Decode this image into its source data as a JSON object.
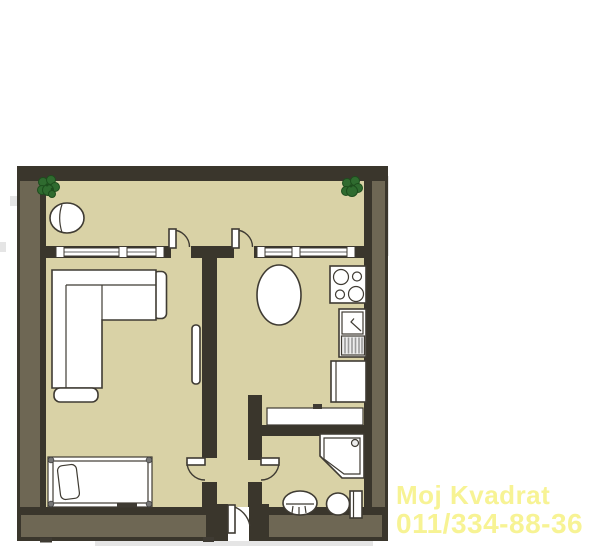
{
  "meta": {
    "type": "floor-plan",
    "description": "Top-down architectural floor plan of a one-bedroom apartment with balcony"
  },
  "watermark": {
    "line1": "Moj Kvadrat",
    "line2": "011/334-88-36"
  },
  "colors": {
    "background": "#ffffff",
    "floor": "#d9d2a6",
    "wall_dark": "#3a362c",
    "wall_light": "#6e6754",
    "furniture_fill": "#ffffff",
    "furniture_stroke": "#3f3b33",
    "plant": "#2f6b2f",
    "plant_dark": "#1d4d1d",
    "drainer": "#ededed",
    "shadow": "#dedede",
    "watermark": "#f7f394"
  },
  "symbols": [
    "balcony-plant-left",
    "balcony-plant-right",
    "balcony-chair",
    "balcony-window-left",
    "balcony-window-right",
    "balcony-door-living",
    "balcony-door-kitchen",
    "corner-sofa",
    "ottoman",
    "radiator",
    "single-bed",
    "pillow",
    "oval-dining-table",
    "stove-4-burners",
    "kitchen-sink-with-drainer",
    "kitchen-cabinet",
    "hall-console",
    "corner-shower",
    "wash-basin",
    "toilet",
    "living-room-door",
    "bathroom-door",
    "entrance-door"
  ]
}
